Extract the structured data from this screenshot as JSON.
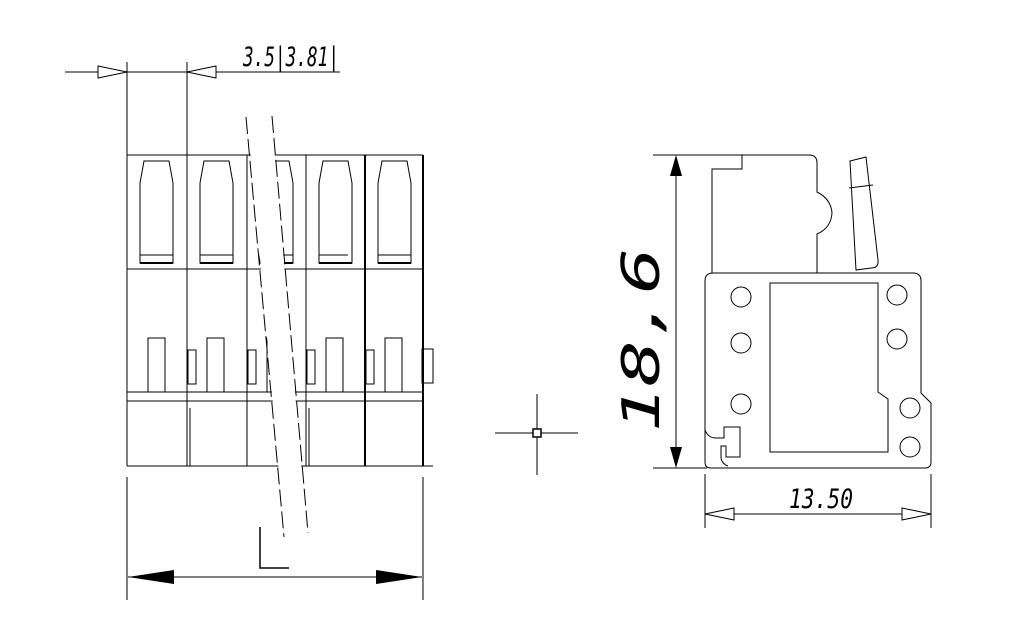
{
  "colors": {
    "line": "#000000",
    "background": "#ffffff"
  },
  "views": {
    "front": {
      "description": "front view of multi-pole terminal block with break lines",
      "dim_pitch": "3.5|3.81|"
    },
    "side": {
      "description": "side profile view of terminal block",
      "dim_height": "18,6",
      "dim_width": "13.50"
    }
  }
}
